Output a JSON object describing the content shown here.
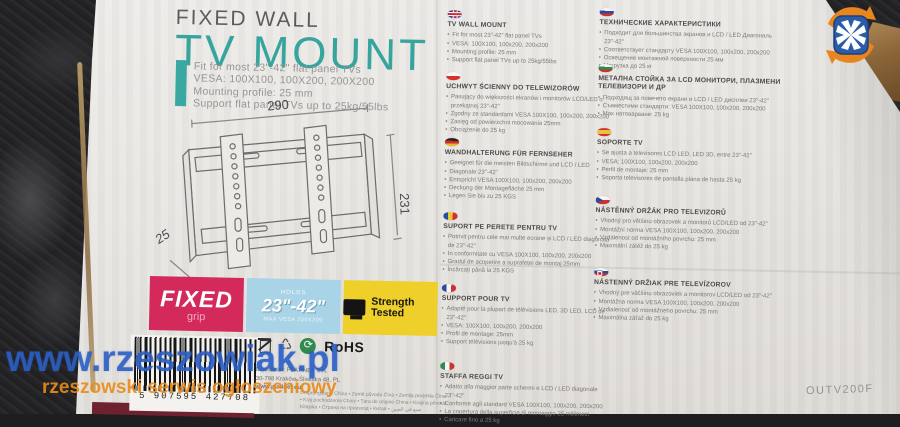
{
  "product": {
    "brand_line": "FIXED WALL",
    "title": "TV MOUNT",
    "description": "Fit for most 23\"-42\" flat panel TVs\nVESA: 100X100, 100X200, 200X200\nMounting profile: 25 mm\nSupport flat panel TVs up to 25kg/55lbs",
    "model": "OUTV200F"
  },
  "diagram": {
    "width_label": "290",
    "height_label": "231",
    "depth_label": "25"
  },
  "badges": {
    "fixed": {
      "title": "FIXED",
      "subtitle": "grip"
    },
    "size": {
      "top": "HOLDS",
      "value": "23\"-42\"",
      "bottom": "MAX VESA 200X200"
    },
    "strength": {
      "label": "Strength Tested"
    }
  },
  "sections_left": [
    {
      "flag": "uk-flag",
      "heading": "TV WALL MOUNT",
      "bullets": [
        "Fit for most 23\"-42\" flat panel TVs",
        "VESA: 100X100, 100x200, 200x200",
        "Mounting profile: 25 mm",
        "Support flat panel TVs up to 25kg/55lbs"
      ]
    },
    {
      "flag": "pl-flag",
      "heading": "UCHWYT ŚCIENNY DO TELEWIZORÓW",
      "bullets": [
        "Pasujący do większości ekranów i monitorów LCD/LED o przekątnej 23\"-42\"",
        "Zgodny ze standardami VESA 100X100, 100x200, 200x200",
        "Zasięg od powierzchni mocowania 25mm",
        "Obciążenie do 25 kg"
      ]
    },
    {
      "flag": "de-flag",
      "heading": "WANDHALTERUNG FÜR FERNSEHER",
      "bullets": [
        "Geeignet für die meisten Bildschirme und LCD / LED",
        "Diagonale 23\"-42\"",
        "Entspricht VESA 100X100, 100x200, 200x200",
        "Deckung der Montagefläche 25 mm",
        "Legen Sie bis zu 25 KGS"
      ]
    },
    {
      "flag": "ro-flag",
      "heading": "SUPORT PE PERETE PENTRU TV",
      "bullets": [
        "Potrivit pentru cele mai multe ecrane și LCD / LED diagonala de 23\"-42\"",
        "In conformitate cu VESA 100X100, 100x200, 200x200",
        "Gradul de acoperire a suprafeței de montaj 25mm",
        "Încărcați până la 25 KGS"
      ]
    },
    {
      "flag": "fr-flag",
      "heading": "SUPPORT POUR TV",
      "bullets": [
        "Adapté pour la plupart de télévisions LED, 3D LED, LCD de 23\"-42\"",
        "VESA: 100X100, 100x200, 200x200",
        "Profil de montage: 25mm",
        "Support télévisions jusqu'à 25 kg"
      ]
    },
    {
      "flag": "it-flag",
      "heading": "STAFFA REGGI TV",
      "bullets": [
        "Adatto alla maggior parte schermi e LCD / LED diagonale 23\"-42\"",
        "Conforme agli standard VESA 100X100, 100x200, 200x200",
        "La copertura della superficie di montaggio 25 millimetri",
        "Caricare fino a 25 kg"
      ]
    }
  ],
  "sections_right": [
    {
      "flag": "ru-flag",
      "heading": "ТЕХНИЧЕСКИЕ ХАРАКТЕРИСТИКИ",
      "bullets": [
        "Подходит для большинства экранов и LCD / LED Диагональ 23\"-42\"",
        "Соответствует стандарту VESA 100X100, 100x200, 200x200",
        "Освещение монтажной поверхности 25 мм",
        "Нагрузка до 25 кг"
      ]
    },
    {
      "flag": "bg-flag",
      "heading": "МЕТАЛНА СТОЙКА ЗА LCD МОНИТОРИ, ПЛАЗМЕНИ ТЕЛЕВИЗОРИ И ДР",
      "bullets": [
        "Подходящ за повечето екрани и LCD / LED дисплеи 23\"-42\"",
        "Съвместими стандарти: VESA 100X100, 100x200, 200x200",
        "Max натоварване: 25 kg"
      ]
    },
    {
      "flag": "es-flag",
      "heading": "SOPORTE TV",
      "bullets": [
        "Se ajusta a televisores LCD LED, LED 3D, entre 23\"-42\"",
        "VESA: 100X100, 100x200, 200x200",
        "Perfil de montaje: 25 mm",
        "Soporta televisores de pantalla plana de hasta 25 kg"
      ]
    },
    {
      "flag": "cz-flag",
      "heading": "NÁSTĚNNÝ DRŽÁK PRO TELEVIZORŮ",
      "bullets": [
        "Vhodný pro většinu obrazovek a monitorů LCD/LED od 23\"-42\"",
        "Montážní norma VESA 100X100, 100x200, 200x200",
        "Vzdálenost od montážního povrchu: 25 mm",
        "Maximální zátěž do 25 kg"
      ]
    },
    {
      "flag": "sk-flag",
      "heading": "NÁSTENNÝ DRŽIAK PRE TELEVÍZOROV",
      "bullets": [
        "Vhodný pre väčšinu obrazoviek a monitorov LCD/LED od 23\"-42\"",
        "Montážna norma VESA 100X100, 100x200, 200x200",
        "Vzdialenosť od montážneho povrchu: 25 mm",
        "Maximálna záťaž do 25 kg"
      ]
    }
  ],
  "compliance": {
    "rohs": "RoHS"
  },
  "distributor": {
    "line1": "Distributor: PLATINET S.A.",
    "line2": "30-798 Kraków, Śliwiaka 48, PL",
    "line3": "www.platinet.eu"
  },
  "origin": {
    "line1": "Ursprungsland China • Země původu Čína • Zemlja porijekla Čína",
    "line2": "• Kraj pochodzenia Chiny • Țara de origine China • Krajina pôvodu:",
    "line3": "Kitajska • Страна на произход • Китай • صنع في الصين"
  },
  "barcode": {
    "digits": "5 907595 427708"
  },
  "watermark": {
    "line1": "www.rzeszowiak.pl",
    "line2": "rzeszowski serwis ogłoszeniowy"
  },
  "colors": {
    "teal": "#3aa8a0",
    "badge_red": "#d42a5b",
    "badge_blue": "#a9d3e6",
    "badge_yellow": "#efd02a",
    "watermark_blue": "#2b5fc4",
    "watermark_orange": "#e98b1a"
  }
}
